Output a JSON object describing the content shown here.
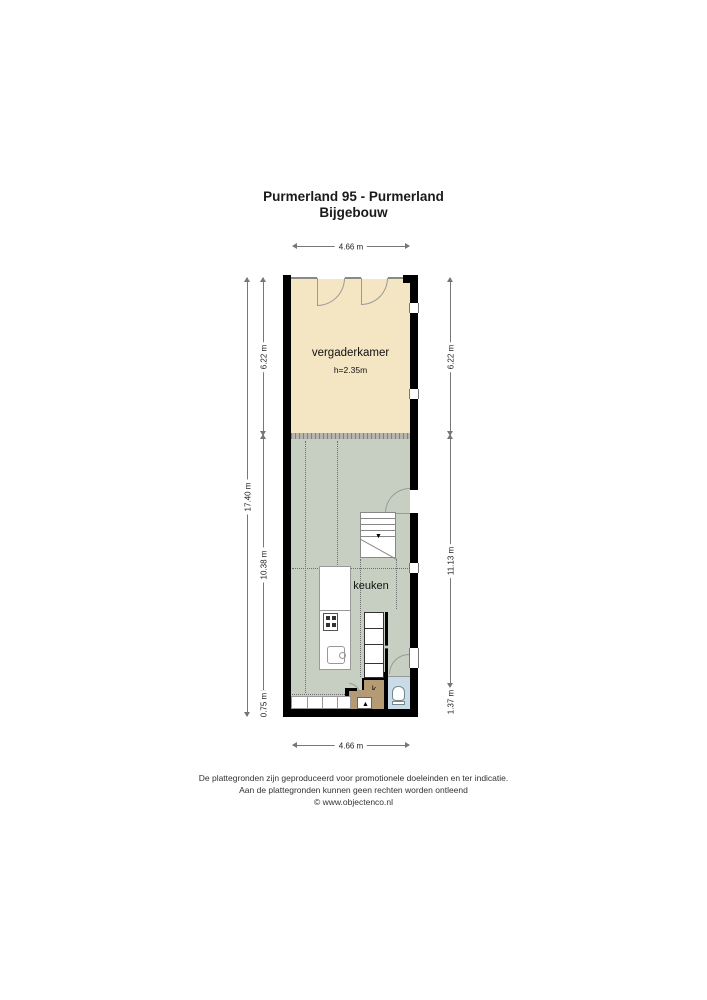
{
  "title": {
    "line1": "Purmerland 95 - Purmerland",
    "line2": "Bijgebouw"
  },
  "dimensions": {
    "top": "4.66 m",
    "bottom": "4.66 m",
    "left_total": "17.40 m",
    "left_segments": [
      "6.22 m",
      "10.38 m",
      "0.75 m"
    ],
    "right_segments": [
      "6.22 m",
      "11.13 m",
      "1.37 m"
    ]
  },
  "rooms": {
    "vergaderkamer": {
      "label": "vergaderkamer",
      "height_note": "h=2.35m"
    },
    "keuken": {
      "label": "keuken"
    },
    "closet": {
      "label": "k"
    }
  },
  "icons": {
    "stairs_direction_arrow": "▼",
    "entrance_arrow": "▲"
  },
  "colors": {
    "wall": "#000000",
    "vergaderkamer": "#f4e6c2",
    "keuken": "#c7cfc3",
    "toilet": "#c9dbe9",
    "hall": "#b49b73",
    "closet": "#b49b73"
  },
  "footer": {
    "line1": "De plattegronden zijn geproduceerd voor promotionele doeleinden en ter indicatie.",
    "line2": "Aan de plattegronden kunnen geen rechten worden ontleend",
    "line3": "© www.objectenco.nl"
  }
}
